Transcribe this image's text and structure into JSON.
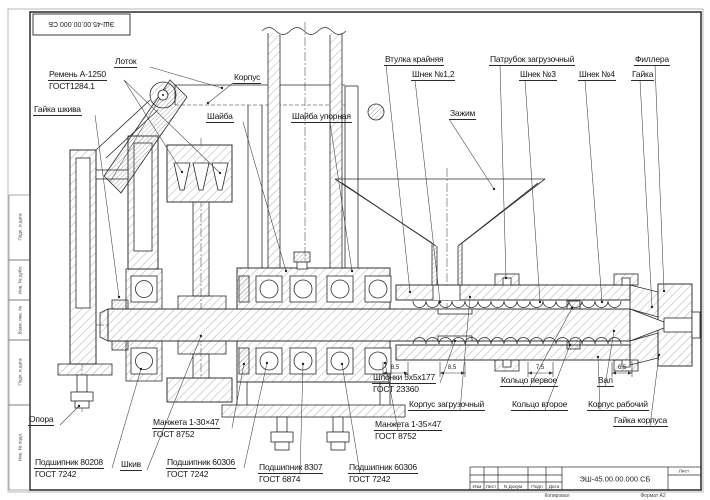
{
  "sheet": {
    "corner_stamp": "ЭШ-45.00.00.000 СБ",
    "side_strip": [
      "Подп. и дата",
      "Инв. № дубл.",
      "Взам. инв. №",
      "Подп. и дата",
      "Инв. № подл."
    ],
    "title_block": {
      "doc_number": "ЭШ-45.00.00.000 СБ",
      "columns": [
        "Изм",
        "Лист",
        "N Докум",
        "Подп",
        "Дата"
      ],
      "sheet_cell": "Лист",
      "copied": "Копировал",
      "format": "Формат А2"
    }
  },
  "labels": {
    "lotok": {
      "l1": "Лоток"
    },
    "remen": {
      "l1": "Ремень А-1250",
      "l2": "ГОСТ1284.1"
    },
    "gayka_shkiva": {
      "l1": "Гайка шкива"
    },
    "korpus": {
      "l1": "Корпус"
    },
    "shayba": {
      "l1": "Шайба"
    },
    "shayba_upornaya": {
      "l1": "Шайба упорная"
    },
    "vtulka_kraynyaya": {
      "l1": "Втулка крайняя"
    },
    "shnek12": {
      "l1": "Шнек №1,2"
    },
    "zazhim": {
      "l1": "Зажим"
    },
    "patrubok": {
      "l1": "Патрубок загрузочный"
    },
    "shnek3": {
      "l1": "Шнек №3"
    },
    "shnek4": {
      "l1": "Шнек №4"
    },
    "fillera": {
      "l1": "Филлера"
    },
    "gayka": {
      "l1": "Гайка"
    },
    "opora": {
      "l1": "Опора"
    },
    "manzheta_30": {
      "l1": "Манжета 1-30×47",
      "l2": "ГОСТ 8752"
    },
    "podshipnik_80208": {
      "l1": "Подшипник 80208",
      "l2": "ГОСТ 7242"
    },
    "shkiv": {
      "l1": "Шкив"
    },
    "podshipnik_60306_1": {
      "l1": "Подшипник 60306",
      "l2": "ГОСТ 7242"
    },
    "podshipnik_8307": {
      "l1": "Подшипник 8307",
      "l2": "ГОСТ 6874"
    },
    "podshipnik_60306_2": {
      "l1": "Подшипник 60306",
      "l2": "ГОСТ 7242"
    },
    "manzheta_35": {
      "l1": "Манжета 1-35×47",
      "l2": "ГОСТ 8752"
    },
    "shponki": {
      "l1": "Шпонки 5х5х177",
      "l2": "ГОСТ 23360"
    },
    "korpus_zagruzochny": {
      "l1": "Корпус загрузочный"
    },
    "koltso_pervoe": {
      "l1": "Кольцо первое"
    },
    "koltso_vtoroe": {
      "l1": "Кольцо второе"
    },
    "val": {
      "l1": "Вал"
    },
    "korpus_rabochiy": {
      "l1": "Корпус рабочий"
    },
    "gayka_korpusa": {
      "l1": "Гайка корпуса"
    }
  },
  "dimensions": {
    "d1": "8,5",
    "d2": "8,5",
    "d3": "7,5",
    "d4": "6,5"
  }
}
